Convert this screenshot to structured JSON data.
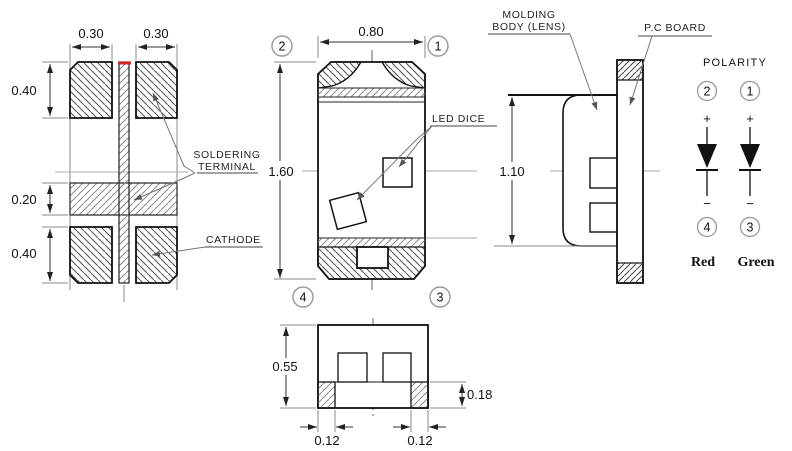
{
  "footprint_view": {
    "dims": {
      "pad_width_left": "0.30",
      "pad_width_right": "0.30",
      "pad_height_top": "0.40",
      "gap_height": "0.20",
      "pad_height_bottom": "0.40"
    },
    "labels": {
      "soldering_terminal_line1": "SOLDERING",
      "soldering_terminal_line2": "TERMINAL",
      "cathode": "CATHODE"
    }
  },
  "top_view": {
    "dims": {
      "width": "0.80",
      "height": "1.60"
    },
    "labels": {
      "led_dice": "LED DICE"
    },
    "pins": {
      "top_left": "2",
      "top_right": "1",
      "bottom_left": "4",
      "bottom_right": "3"
    }
  },
  "side_view": {
    "dims": {
      "height": "1.10"
    },
    "labels": {
      "molding_line1": "MOLDING",
      "molding_line2": "BODY (LENS)",
      "pc_board": "P.C BOARD"
    }
  },
  "bottom_view": {
    "dims": {
      "height": "0.55",
      "terminal_height": "0.18",
      "terminal_width_left": "0.12",
      "terminal_width_right": "0.12"
    }
  },
  "polarity": {
    "title": "POLARITY",
    "left_diode": {
      "top_pin": "2",
      "plus": "+",
      "minus": "−",
      "bottom_pin": "4",
      "color_name": "Red"
    },
    "right_diode": {
      "top_pin": "1",
      "plus": "+",
      "minus": "−",
      "bottom_pin": "3",
      "color_name": "Green"
    }
  },
  "colors": {
    "line": "#111111",
    "secondary": "#777777",
    "centerline": "#aaaaaa",
    "polarity_mark_red": "#cc2222",
    "background": "#ffffff"
  }
}
